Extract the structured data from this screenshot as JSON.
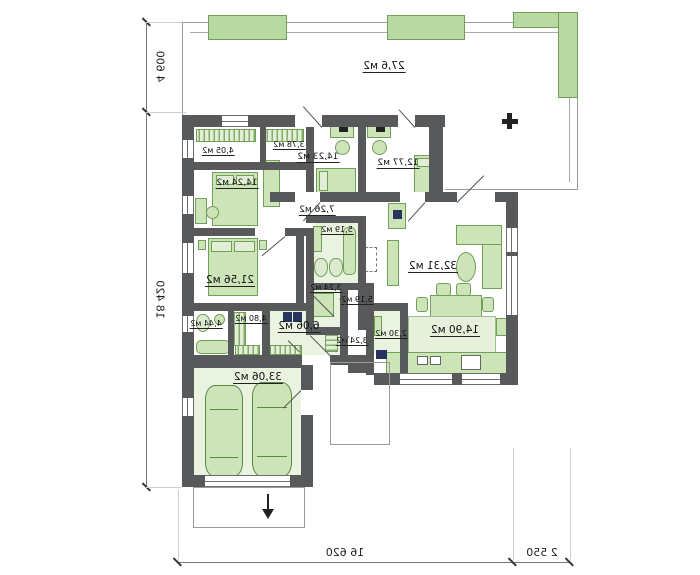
{
  "rooms": {
    "terrace": "27,6 м2",
    "wardrobe_a": "4,05 м2",
    "wardrobe_b": "3,78 м2",
    "bedroom_a": "14,23 м2",
    "bedroom_b": "12,77 м2",
    "bedroom_c": "14,24 м2",
    "hallway": "7,26 м2",
    "bathroom_a": "5,19 м2",
    "master_bedroom": "21,56 м2",
    "living_room": "32,31 м2",
    "wc_a": "3,24 м2",
    "shower_room": "5,19 м2",
    "wc_b": "3,24 м2",
    "pantry": "2,30 м2",
    "bathroom_b": "4,44 м2",
    "laundry": "4,80 м2",
    "hall": "6,06 м2",
    "kitchen": "14,90 м2",
    "garage": "33,06 м2"
  },
  "dimensions": {
    "terrace_depth": "4 600",
    "side_total": "18 420",
    "bottom_main": "16 620",
    "bottom_porch": "2 550"
  },
  "colors": {
    "wall": "#58595b",
    "furniture": "#cde4b8",
    "furniture_border": "#71a058",
    "planter": "#b9d9a3",
    "floor_tint": "#eaf2e0"
  }
}
